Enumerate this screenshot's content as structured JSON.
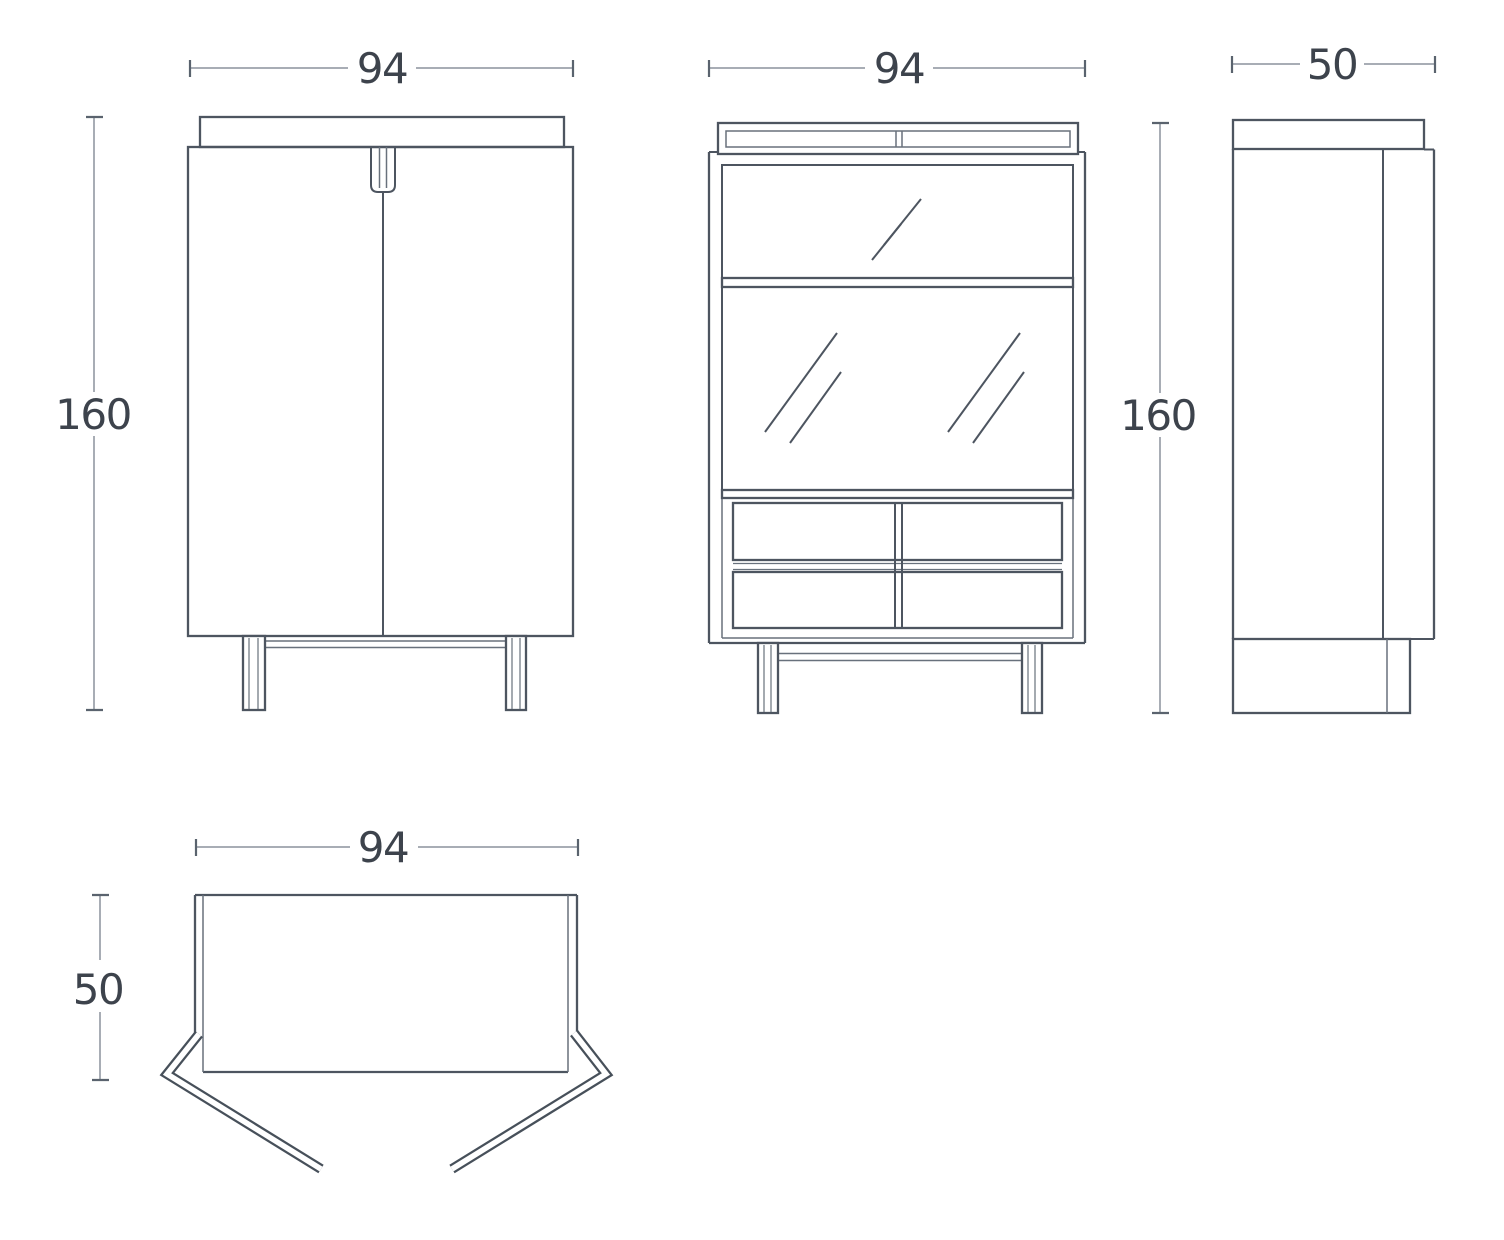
{
  "dimensions": {
    "front_width": "94",
    "front_height": "160",
    "open_width": "94",
    "side_height": "160",
    "side_depth": "50",
    "plan_width": "94",
    "plan_depth": "50"
  },
  "colors": {
    "line": "#4d5560",
    "line_light": "#68717c",
    "dim_line": "#a8adb5",
    "tick": "#5a636e",
    "text": "#3d434c",
    "background": "#ffffff"
  }
}
